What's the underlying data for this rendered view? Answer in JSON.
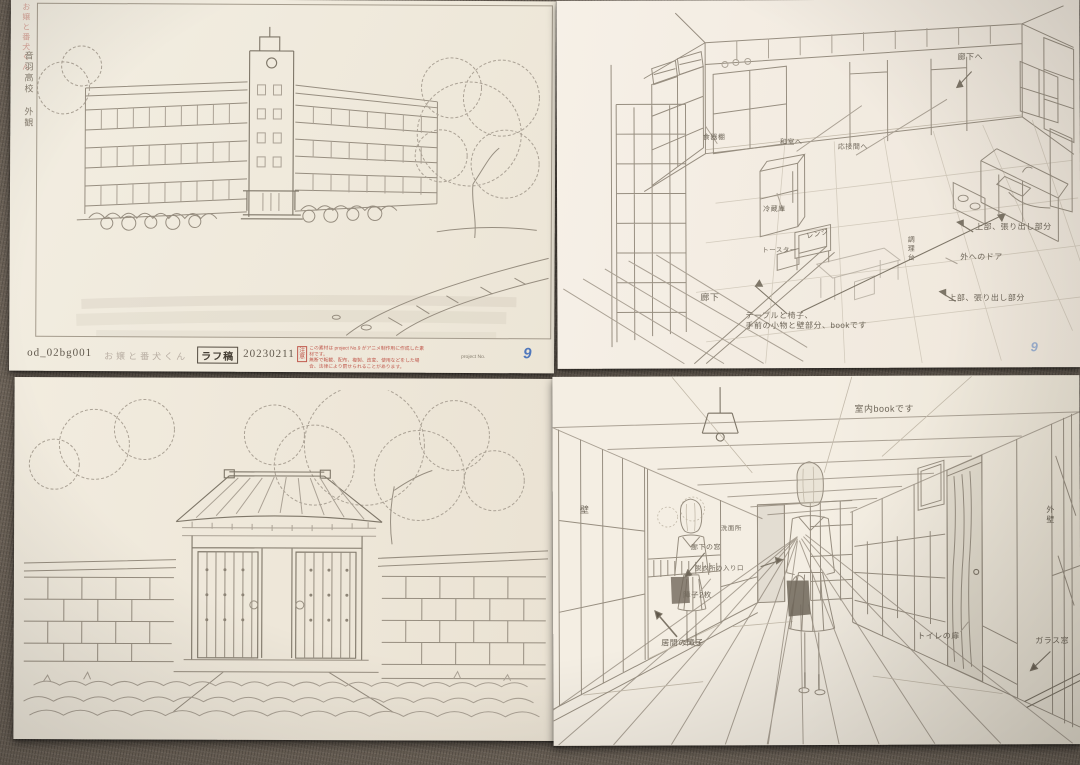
{
  "colors": {
    "surface": "#6e6459",
    "paper": "#f3eee2",
    "pencil": "#978e80",
    "stamp_red": "#c05a4e",
    "logo_blue": "#3566b8"
  },
  "school_sheet": {
    "side_title": "お嬢と番犬くん",
    "side_location": "音羽高校",
    "side_view": "外観",
    "footer": {
      "cut_no": "od_02bg001",
      "work_title": "お嬢と番犬くん",
      "stage": "ラフ稿",
      "date": "20230211",
      "notice_label": "注意",
      "notice_line1": "この素材は project No.9 がアニメ制作用に作成した素材です。",
      "notice_line2": "無断で転載、配布、複製、改変、使用などをした場合、法律により罰せられることがあります。",
      "studio_text": "project No.",
      "studio_logo": "9"
    }
  },
  "kitchen_sheet": {
    "labels": {
      "to_hallway": "廊下へ",
      "cupboard": "食器棚",
      "to_washitsu": "和室へ",
      "to_drawing_room": "応接間へ",
      "fridge": "冷蔵庫",
      "range": "レンジ",
      "toaster": "トースター",
      "counter": "調理台",
      "upper_overhang_1": "上部、張り出し部分",
      "door_outside": "外へのドア",
      "upper_overhang_2": "上部、張り出し部分",
      "hallway": "廊下",
      "note_line1": "テーブルと椅子、",
      "note_line2": "手前の小物と壁部分、bookです"
    },
    "logo": "9"
  },
  "hallway_sheet": {
    "labels": {
      "interior_book": "室内bookです",
      "wall": "壁",
      "washroom": "洗面所",
      "hall_window": "廊下の窓",
      "dressing_entrance": "脱衣所の入り口",
      "shoji_two": "障子2枚",
      "living_shoji": "居間の障子",
      "toilet_door": "トイレの扉",
      "outer_wall": "外壁",
      "glass_window": "ガラス窓"
    }
  }
}
